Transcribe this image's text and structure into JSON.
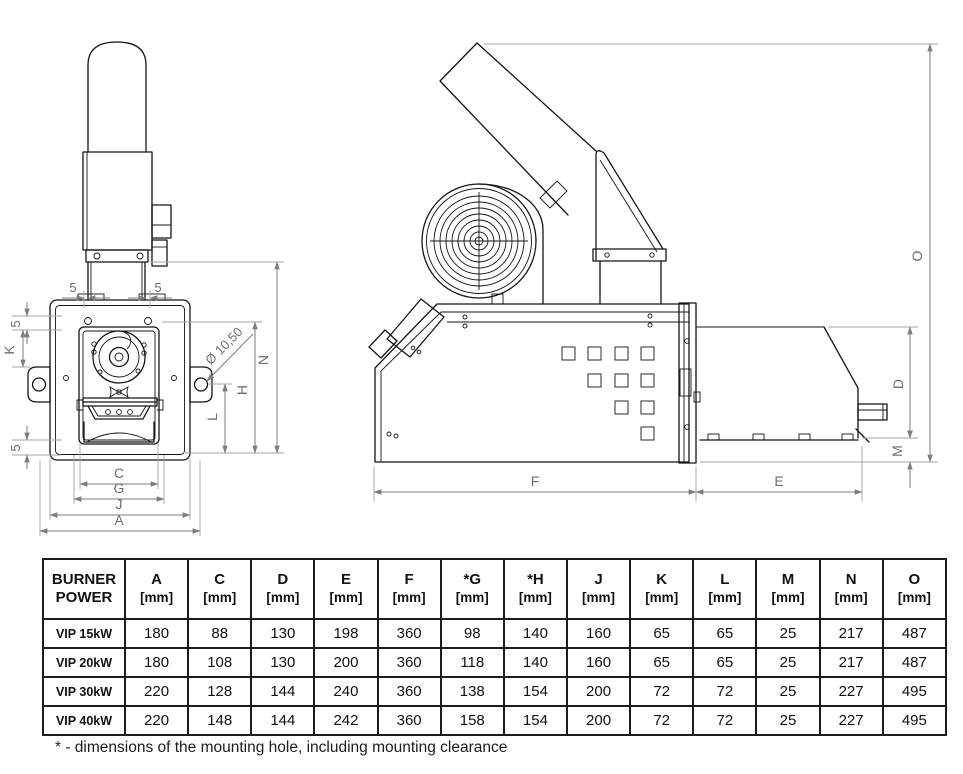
{
  "drawing": {
    "front": {
      "labels": {
        "offset_top_left": "5",
        "offset_top_right": "5",
        "offset_left_top": "5",
        "k": "K",
        "offset_left_bottom": "5",
        "hole_dia": "Ø 10,50",
        "l": "L",
        "h": "H",
        "n": "N",
        "c": "C",
        "g": "G",
        "j": "J",
        "a": "A"
      }
    },
    "side": {
      "labels": {
        "f": "F",
        "e": "E",
        "d": "D",
        "m": "M",
        "o": "O"
      }
    }
  },
  "table": {
    "header": [
      {
        "line1": "BURNER",
        "line2": "POWER"
      },
      {
        "line1": "A",
        "line2": "[mm]"
      },
      {
        "line1": "C",
        "line2": "[mm]"
      },
      {
        "line1": "D",
        "line2": "[mm]"
      },
      {
        "line1": "E",
        "line2": "[mm]"
      },
      {
        "line1": "F",
        "line2": "[mm]"
      },
      {
        "line1": "*G",
        "line2": "[mm]"
      },
      {
        "line1": "*H",
        "line2": "[mm]"
      },
      {
        "line1": "J",
        "line2": "[mm]"
      },
      {
        "line1": "K",
        "line2": "[mm]"
      },
      {
        "line1": "L",
        "line2": "[mm]"
      },
      {
        "line1": "M",
        "line2": "[mm]"
      },
      {
        "line1": "N",
        "line2": "[mm]"
      },
      {
        "line1": "O",
        "line2": "[mm]"
      }
    ],
    "rows": [
      {
        "model": "VIP 15kW",
        "values": [
          "180",
          "88",
          "130",
          "198",
          "360",
          "98",
          "140",
          "160",
          "65",
          "65",
          "25",
          "217",
          "487"
        ]
      },
      {
        "model": "VIP 20kW",
        "values": [
          "180",
          "108",
          "130",
          "200",
          "360",
          "118",
          "140",
          "160",
          "65",
          "65",
          "25",
          "217",
          "487"
        ]
      },
      {
        "model": "VIP 30kW",
        "values": [
          "220",
          "128",
          "144",
          "240",
          "360",
          "138",
          "154",
          "200",
          "72",
          "72",
          "25",
          "227",
          "495"
        ]
      },
      {
        "model": "VIP 40kW",
        "values": [
          "220",
          "148",
          "144",
          "242",
          "360",
          "158",
          "154",
          "200",
          "72",
          "72",
          "25",
          "227",
          "495"
        ]
      }
    ]
  },
  "footnote": "* - dimensions of the mounting hole, including mounting clearance"
}
